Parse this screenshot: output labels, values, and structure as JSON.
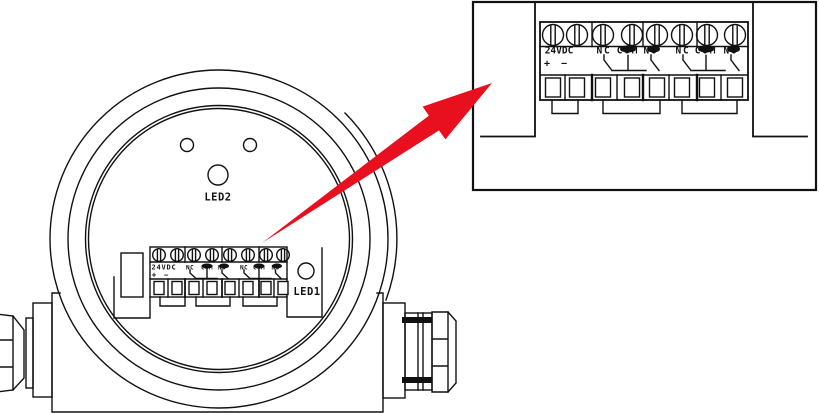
{
  "colors": {
    "line": "#111111",
    "arrow": "#e8101e",
    "background": "#ffffff"
  },
  "device_view": {
    "led2_label": "LED2",
    "led1_label": "LED1"
  },
  "terminal_labels": {
    "power": "24VDC",
    "plus": "+",
    "minus": "−",
    "relay1": {
      "nc": "NC",
      "com": "COM",
      "no": "NO"
    },
    "relay2": {
      "nc": "NC",
      "com": "COM",
      "no": "NO"
    }
  }
}
